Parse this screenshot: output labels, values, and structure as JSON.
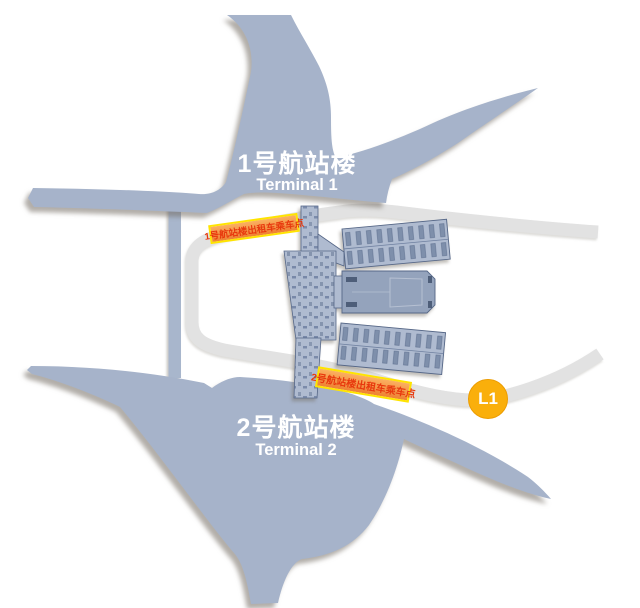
{
  "map": {
    "terminal1": {
      "title_zh": "1号航站楼",
      "title_en": "Terminal 1"
    },
    "terminal2": {
      "title_zh": "2号航站楼",
      "title_en": "Terminal 2"
    },
    "markers": {
      "t1_taxi_label": "1号航站楼出租车乘车点",
      "t2_taxi_label": "2号航站楼出租车乘车点",
      "level_badge": "L1"
    },
    "colors": {
      "terminal_fill": "#a6b3ca",
      "road_gray": "#e2e2e2",
      "road_blue": "#a8b6cc",
      "building_fill": "#afbbd0",
      "building_mid_fill": "#94a3bc",
      "building_stroke": "#566787",
      "label_orange_top": "#fbb061",
      "label_orange_bottom": "#ee8133",
      "label_border_yellow": "#ffe400",
      "label_text_red": "#e8380d",
      "badge_yellow": "#faaf0b"
    }
  }
}
